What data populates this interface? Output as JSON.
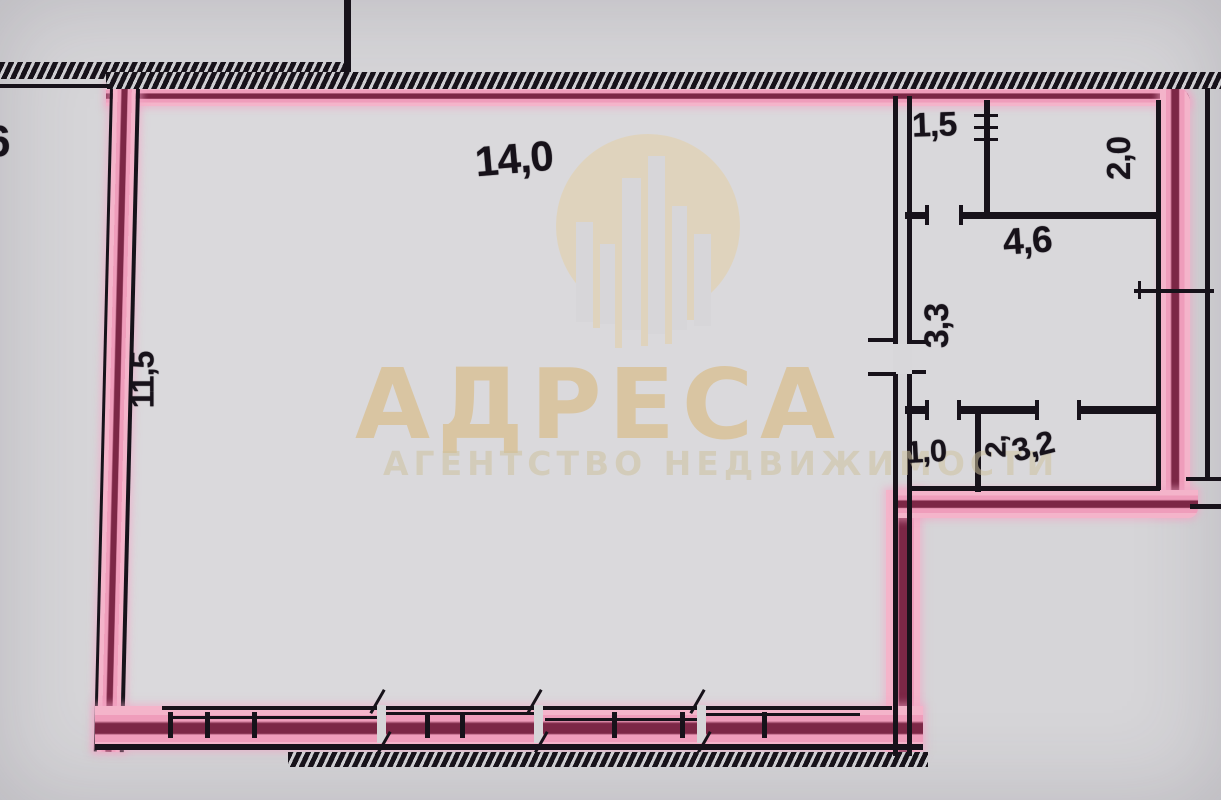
{
  "plan": {
    "labels": {
      "main_width": "14,0",
      "main_depth": "11,5",
      "pantry": "1,5",
      "niche_width": "2,0",
      "kitchen": "4,6",
      "hall_depth": "3,3",
      "wc": "1,0",
      "bath_depth": "2,",
      "bath_width": "3,2",
      "edge_clipped": "6"
    }
  },
  "watermark": {
    "logo": "buildings-in-circle",
    "title": "АДРЕСА",
    "subtitle": "АГЕНТСТВО НЕДВИЖИМОСТИ"
  },
  "colors": {
    "background": "#d6d5d8",
    "wall_ink": "#17121a",
    "highlight_pink": "#ef9dbb",
    "highlight_core": "#7c2746",
    "watermark_gold": "#d9b36a",
    "watermark_gold_soft": "#cfc3a0"
  }
}
